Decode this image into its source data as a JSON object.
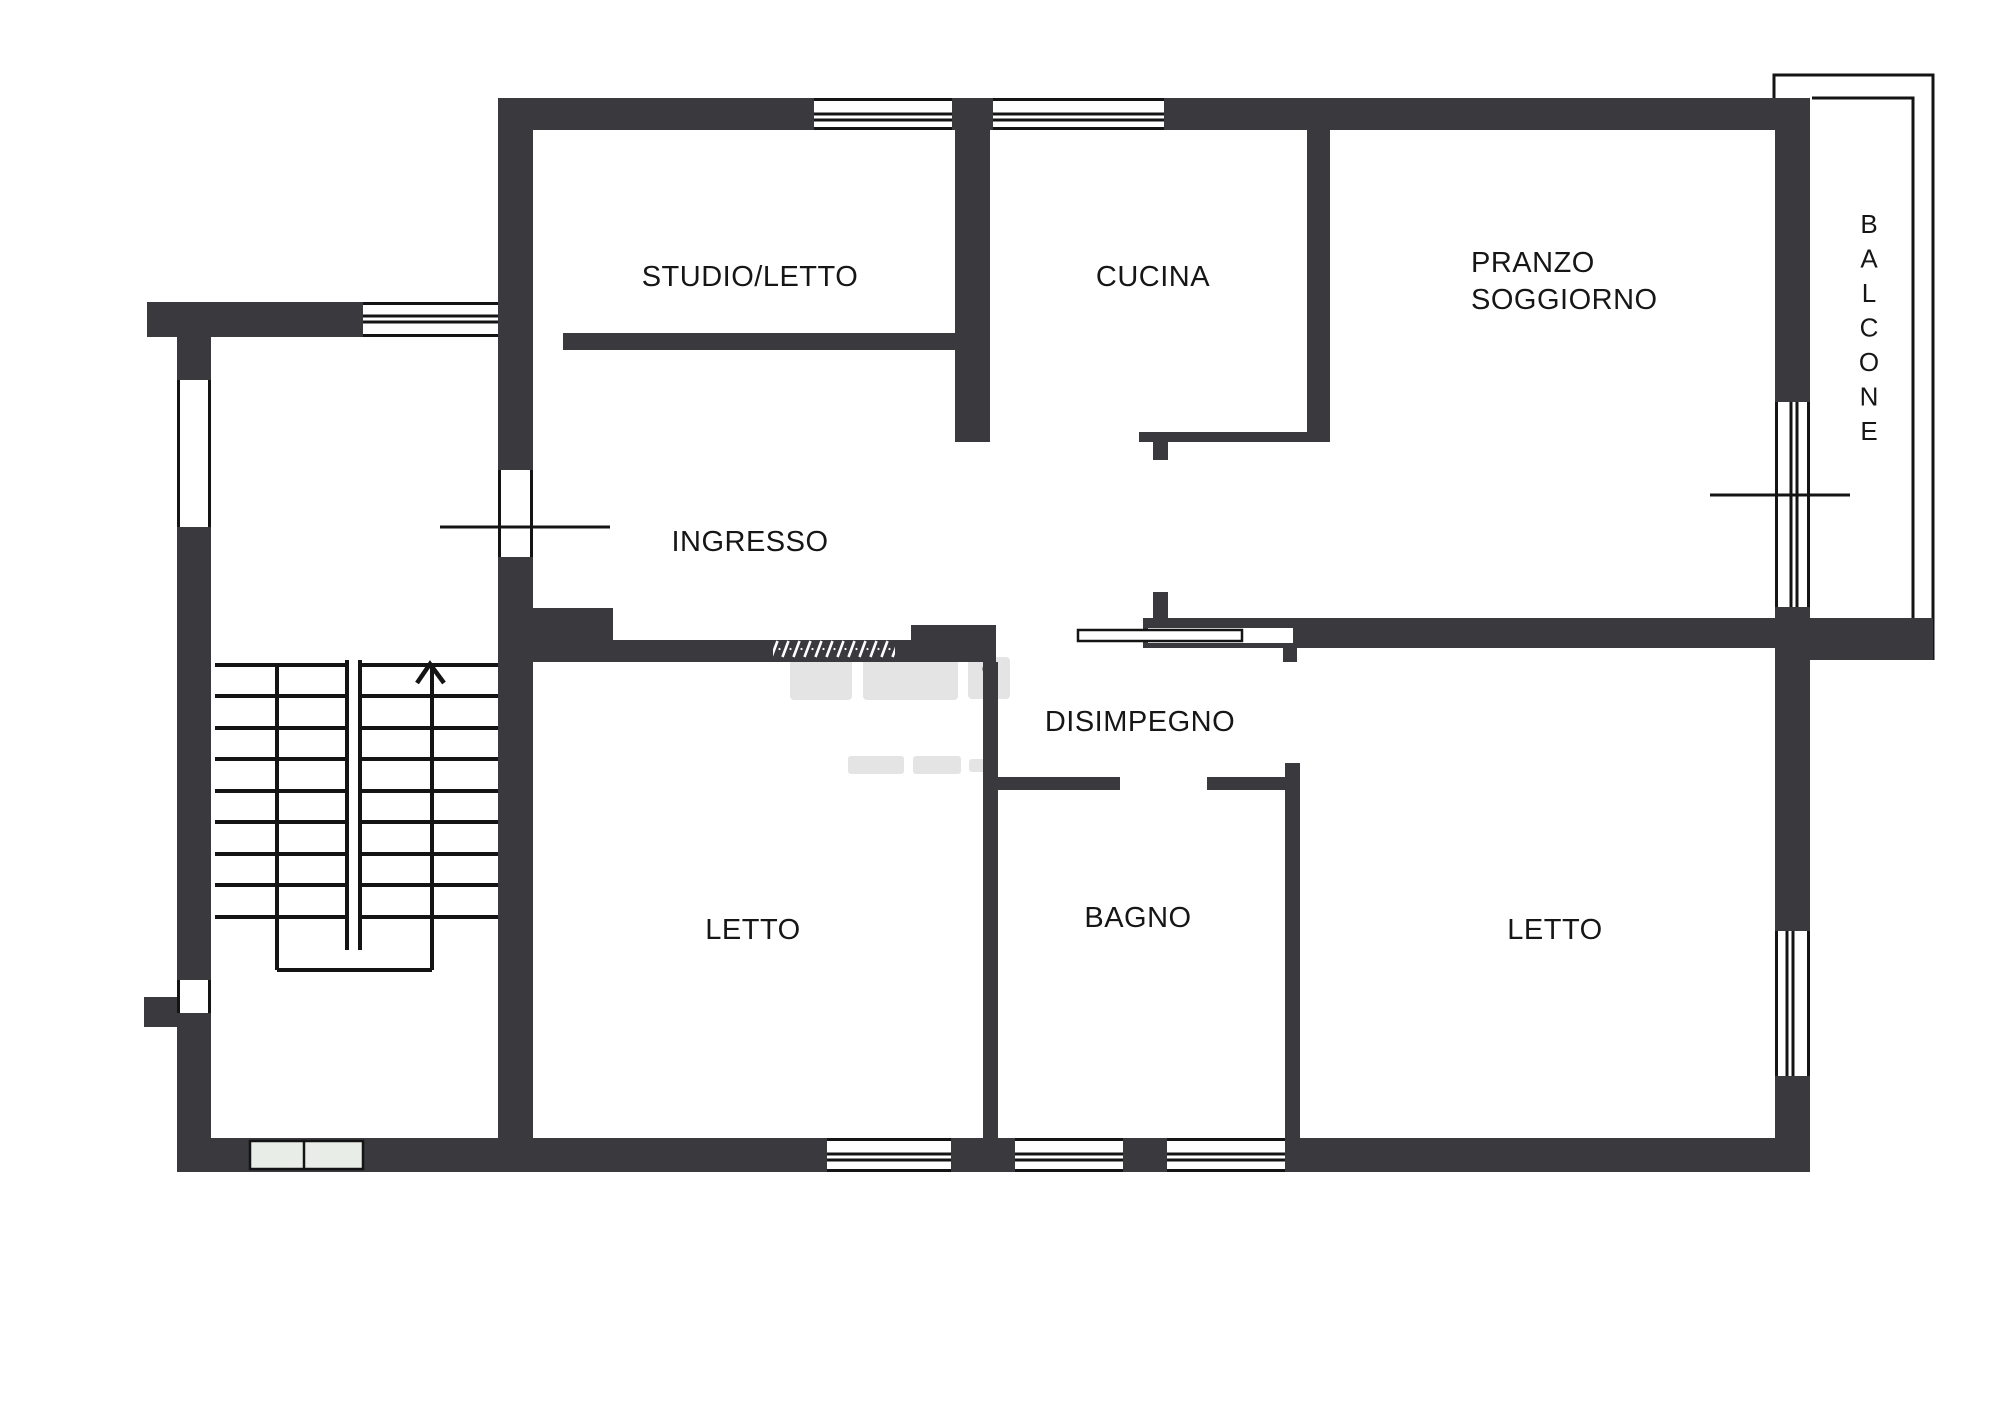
{
  "page": {
    "background": "#ffffff"
  },
  "colors": {
    "wall": "#3a393d",
    "line": "#141414",
    "pale_window": "#e9ede8",
    "watermark": "#c9c9c9"
  },
  "rooms": {
    "studio_letto": "STUDIO/LETTO",
    "cucina": "CUCINA",
    "pranzo_line1": "PRANZO",
    "pranzo_line2": "SOGGIORNO",
    "ingresso": "INGRESSO",
    "disimpegno": "DISIMPEGNO",
    "letto_left": "LETTO",
    "bagno": "BAGNO",
    "letto_right": "LETTO",
    "balcone": "BALCONE"
  },
  "stairs": {
    "direction": "up"
  }
}
